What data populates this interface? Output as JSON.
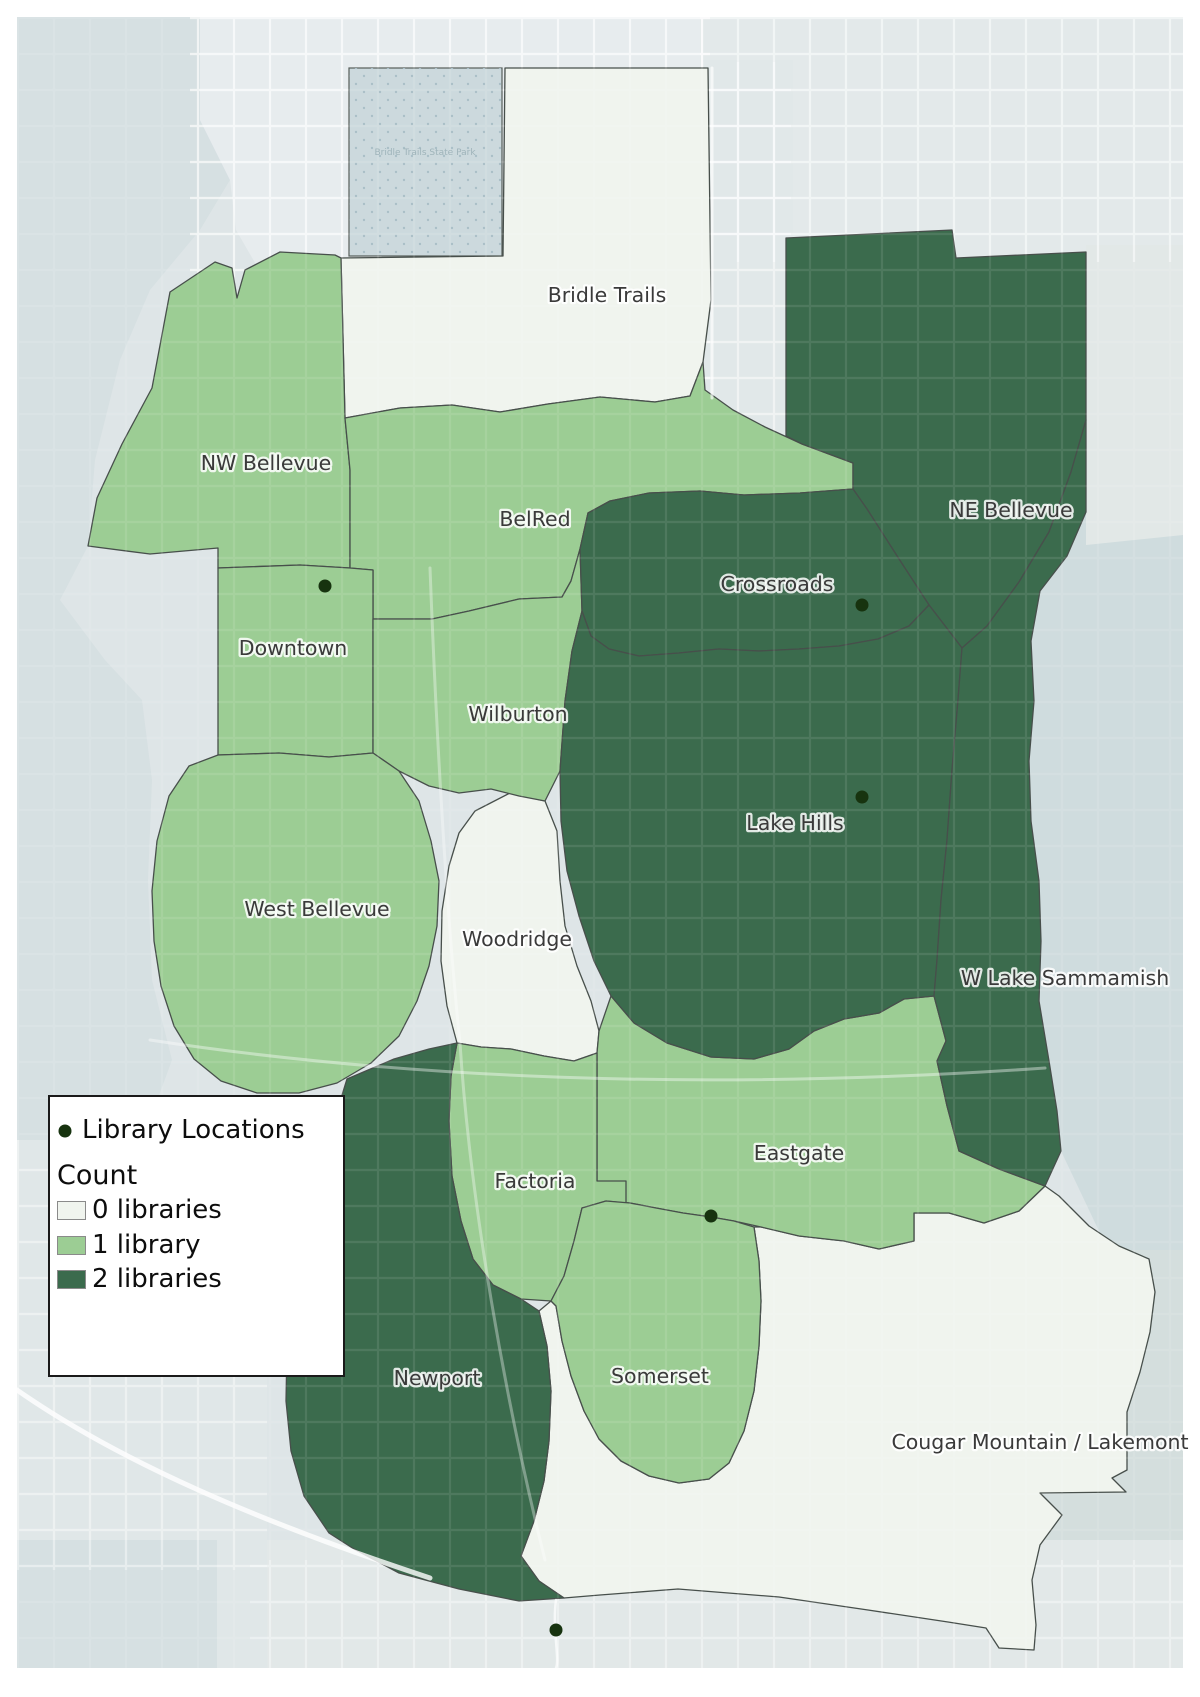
{
  "legend": {
    "library_locations_label": "Library Locations",
    "count_title": "Count",
    "items": [
      {
        "label": "0 libraries",
        "color": "#F0F4EE"
      },
      {
        "label": "1 library",
        "color": "#9CCD94"
      },
      {
        "label": "2 libraries",
        "color": "#3B6B4D"
      }
    ]
  },
  "map": {
    "library_dot_color": "#17330F",
    "basemap_park_label": "Bridle Trails State Park",
    "library_locations": [
      {
        "x": 325,
        "y": 586
      },
      {
        "x": 862,
        "y": 605
      },
      {
        "x": 862,
        "y": 797
      },
      {
        "x": 711,
        "y": 1216
      },
      {
        "x": 556,
        "y": 1630
      }
    ],
    "regions": [
      {
        "name": "Bridle Trails",
        "count": 0,
        "fill": "#F0F4EE"
      },
      {
        "name": "NW Bellevue",
        "count": 1,
        "fill": "#9CCD94"
      },
      {
        "name": "BelRed",
        "count": 1,
        "fill": "#9CCD94"
      },
      {
        "name": "NE Bellevue",
        "count": 2,
        "fill": "#3B6B4D"
      },
      {
        "name": "Crossroads",
        "count": 2,
        "fill": "#3B6B4D"
      },
      {
        "name": "Downtown",
        "count": 1,
        "fill": "#9CCD94"
      },
      {
        "name": "Wilburton",
        "count": 1,
        "fill": "#9CCD94"
      },
      {
        "name": "Lake Hills",
        "count": 2,
        "fill": "#3B6B4D"
      },
      {
        "name": "West Bellevue",
        "count": 1,
        "fill": "#9CCD94"
      },
      {
        "name": "Woodridge",
        "count": 0,
        "fill": "#F0F4EE"
      },
      {
        "name": "W Lake Sammamish",
        "count": 2,
        "fill": "#3B6B4D"
      },
      {
        "name": "Eastgate",
        "count": 1,
        "fill": "#9CCD94"
      },
      {
        "name": "Factoria",
        "count": 1,
        "fill": "#9CCD94"
      },
      {
        "name": "Newport",
        "count": 2,
        "fill": "#3B6B4D"
      },
      {
        "name": "Somerset",
        "count": 1,
        "fill": "#9CCD94"
      },
      {
        "name": "Cougar Mountain / Lakemont",
        "count": 0,
        "fill": "#F0F4EE"
      }
    ]
  }
}
